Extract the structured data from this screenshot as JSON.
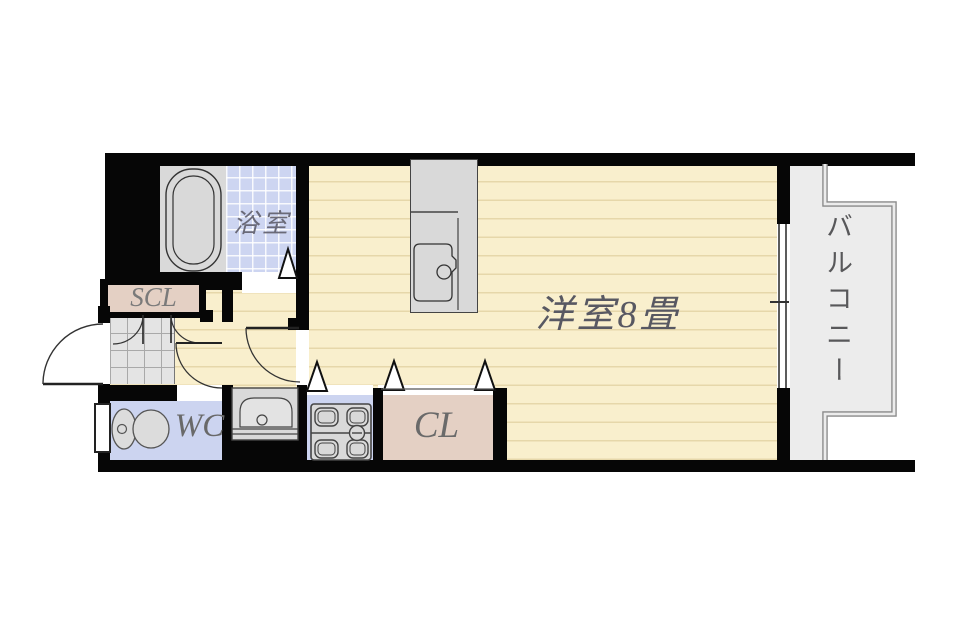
{
  "floorplan": {
    "title": "1R apartment floor plan",
    "rooms": {
      "bathroom": {
        "label": "浴室"
      },
      "shoe_closet": {
        "label": "SCL"
      },
      "toilet_room": {
        "label": "WC"
      },
      "closet": {
        "label": "CL"
      },
      "main_room": {
        "label": "洋室8畳"
      },
      "balcony": {
        "label": "バルコニー"
      }
    },
    "fixtures": [
      "bathtub",
      "kitchen-sink",
      "washbasin",
      "gas-stove",
      "toilet",
      "sliding-window",
      "entrance-door"
    ],
    "colors": {
      "wall": "#060606",
      "floor_cream": "#f9efcd",
      "floor_line": "#e6d7aa",
      "tile_blue": "#cdd5f1",
      "wet_blue": "#ccd4f0",
      "closet_pink": "#e4d0c4",
      "fixture_gray": "#d9d9d9",
      "balcony_gray": "#ececec",
      "label_gray": "#66666e"
    }
  }
}
